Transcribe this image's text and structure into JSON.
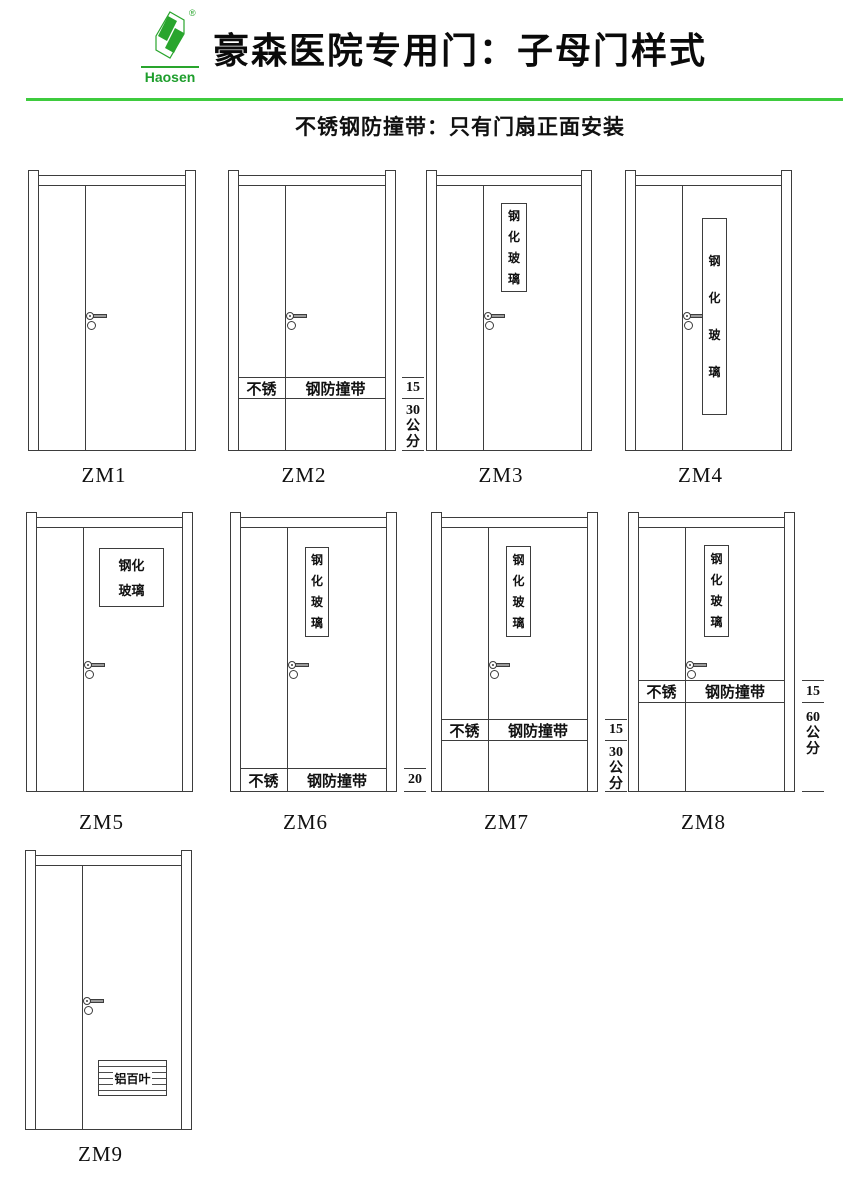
{
  "header": {
    "brand": "Haosen",
    "registered": "®",
    "title": "豪森医院专用门：子母门样式",
    "subtitle": "不锈钢防撞带：只有门扇正面安装"
  },
  "colors": {
    "logo_green": "#29a52d",
    "divider_line_green": "#3ecb3e",
    "drawing_line": "#3d3d3d"
  },
  "doors": [
    {
      "label": "ZM1"
    },
    {
      "label": "ZM2",
      "band": {
        "left": "不锈",
        "right": "钢防撞带"
      },
      "dim": {
        "band_height": "15",
        "offset_value": "30",
        "offset_unit": "公分"
      }
    },
    {
      "label": "ZM3",
      "glass": "钢化玻璃"
    },
    {
      "label": "ZM4",
      "glass": "钢化玻璃"
    },
    {
      "label": "ZM5",
      "glass": "钢化玻璃"
    },
    {
      "label": "ZM6",
      "glass": "钢化玻璃",
      "band": {
        "left": "不锈",
        "right": "钢防撞带"
      },
      "dim": {
        "band_height": "20"
      }
    },
    {
      "label": "ZM7",
      "glass": "钢化玻璃",
      "band": {
        "left": "不锈",
        "right": "钢防撞带"
      },
      "dim": {
        "band_height": "15",
        "offset_value": "30",
        "offset_unit": "公分"
      }
    },
    {
      "label": "ZM8",
      "glass": "钢化玻璃",
      "band": {
        "left": "不锈",
        "right": "钢防撞带"
      },
      "dim": {
        "band_height": "15",
        "offset_value": "60",
        "offset_unit": "公分"
      }
    },
    {
      "label": "ZM9",
      "louver": "铝百叶"
    }
  ]
}
